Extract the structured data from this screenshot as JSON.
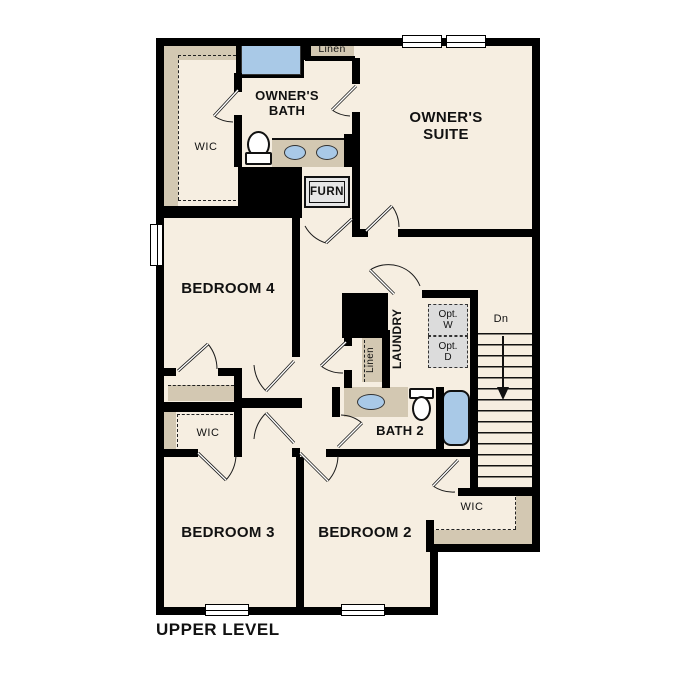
{
  "plan_title": "UPPER LEVEL",
  "rooms": {
    "owners_suite": "OWNER'S SUITE",
    "owners_bath": "OWNER'S BATH",
    "owners_wic": "WIC",
    "bedroom4": "BEDROOM 4",
    "bedroom3": "BEDROOM 3",
    "bedroom2": "BEDROOM 2",
    "bedroom3_wic": "WIC",
    "bedroom2_wic": "WIC",
    "bath2": "BATH 2",
    "laundry": "LAUNDRY"
  },
  "closets": {
    "linen_top": "Linen",
    "linen_hall": "Linen"
  },
  "labels": {
    "furnace": "FURN",
    "stairs_down": "Dn",
    "opt_washer": "Opt. W",
    "opt_dryer": "Opt. D"
  },
  "colors": {
    "floor": "#f6eee1",
    "shelf": "#d3c8b2",
    "fixture_blue": "#a9c9e7",
    "wall": "#000000",
    "appliance_gray": "#dcdcdc"
  }
}
